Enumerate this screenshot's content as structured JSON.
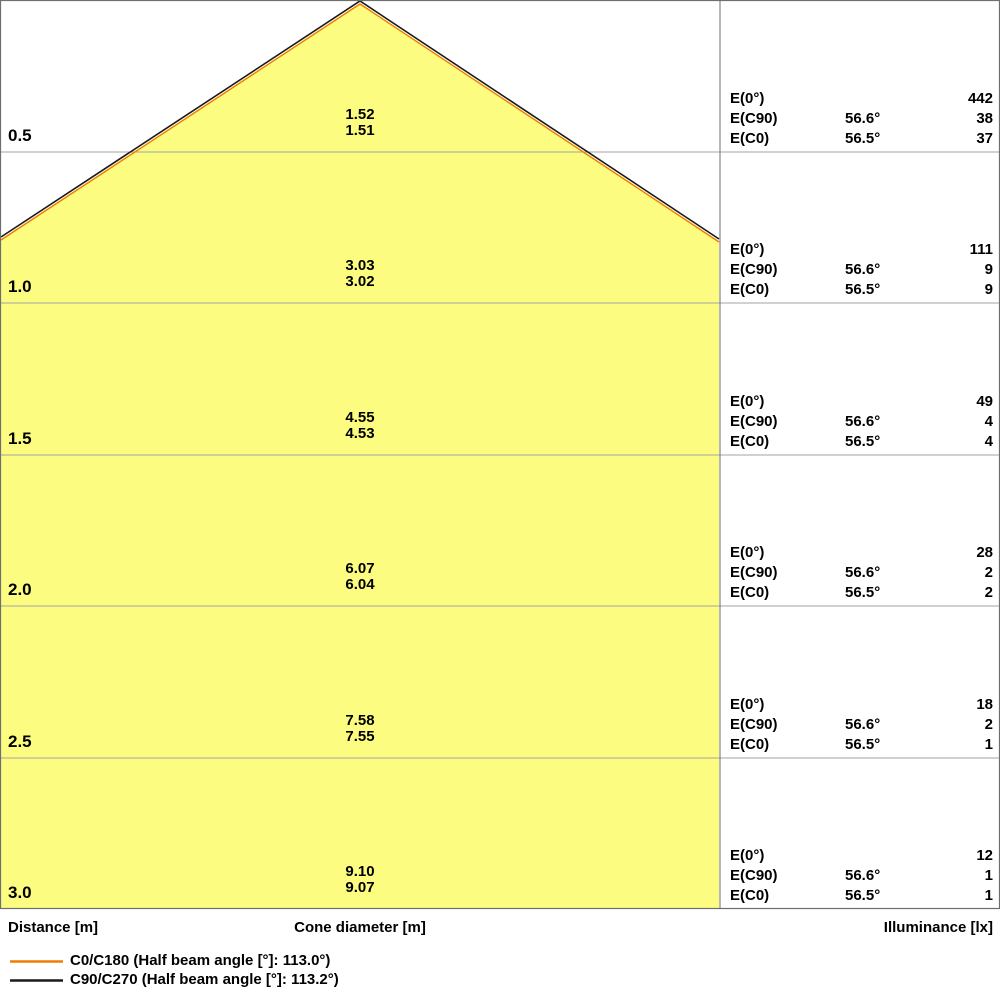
{
  "chart_data": {
    "type": "area",
    "subtype": "light-cone-diagram",
    "axes": {
      "distance_label": "Distance [m]",
      "cone_diameter_label": "Cone diameter [m]",
      "illuminance_label": "Illuminance [lx]"
    },
    "distances_m": [
      0.5,
      1.0,
      1.5,
      2.0,
      2.5,
      3.0
    ],
    "rows": [
      {
        "distance": "0.5",
        "diameters": [
          "1.52",
          "1.51"
        ],
        "illuminance": [
          {
            "label": "E(0°)",
            "angle": "",
            "value": "442"
          },
          {
            "label": "E(C90)",
            "angle": "56.6°",
            "value": "38"
          },
          {
            "label": "E(C0)",
            "angle": "56.5°",
            "value": "37"
          }
        ]
      },
      {
        "distance": "1.0",
        "diameters": [
          "3.03",
          "3.02"
        ],
        "illuminance": [
          {
            "label": "E(0°)",
            "angle": "",
            "value": "111"
          },
          {
            "label": "E(C90)",
            "angle": "56.6°",
            "value": "9"
          },
          {
            "label": "E(C0)",
            "angle": "56.5°",
            "value": "9"
          }
        ]
      },
      {
        "distance": "1.5",
        "diameters": [
          "4.55",
          "4.53"
        ],
        "illuminance": [
          {
            "label": "E(0°)",
            "angle": "",
            "value": "49"
          },
          {
            "label": "E(C90)",
            "angle": "56.6°",
            "value": "4"
          },
          {
            "label": "E(C0)",
            "angle": "56.5°",
            "value": "4"
          }
        ]
      },
      {
        "distance": "2.0",
        "diameters": [
          "6.07",
          "6.04"
        ],
        "illuminance": [
          {
            "label": "E(0°)",
            "angle": "",
            "value": "28"
          },
          {
            "label": "E(C90)",
            "angle": "56.6°",
            "value": "2"
          },
          {
            "label": "E(C0)",
            "angle": "56.5°",
            "value": "2"
          }
        ]
      },
      {
        "distance": "2.5",
        "diameters": [
          "7.58",
          "7.55"
        ],
        "illuminance": [
          {
            "label": "E(0°)",
            "angle": "",
            "value": "18"
          },
          {
            "label": "E(C90)",
            "angle": "56.6°",
            "value": "2"
          },
          {
            "label": "E(C0)",
            "angle": "56.5°",
            "value": "1"
          }
        ]
      },
      {
        "distance": "3.0",
        "diameters": [
          "9.10",
          "9.07"
        ],
        "illuminance": [
          {
            "label": "E(0°)",
            "angle": "",
            "value": "12"
          },
          {
            "label": "E(C90)",
            "angle": "56.6°",
            "value": "1"
          },
          {
            "label": "E(C0)",
            "angle": "56.5°",
            "value": "1"
          }
        ]
      }
    ],
    "legend": [
      {
        "label": "C0/C180 (Half beam angle [°]: 113.0°)",
        "color": "#F07D00"
      },
      {
        "label": "C90/C270 (Half beam angle [°]: 113.2°)",
        "color": "#1A1A1A"
      }
    ],
    "half_beam_angles": {
      "c0_c180": "113.0°",
      "c90_c270": "113.2°"
    },
    "colors": {
      "cone_fill": "#FCFC80",
      "grid_line": "#A3A3A3",
      "border": "#6E6E6E",
      "edge_c0": "#F07D00",
      "edge_c90": "#1A1A1A"
    }
  }
}
